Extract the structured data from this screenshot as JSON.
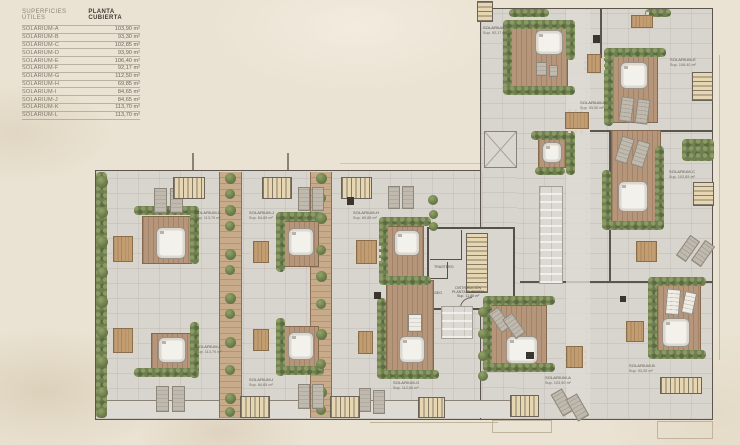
{
  "legend": {
    "title_left": "SUPERFICIES ÚTILES",
    "title_right": "PLANTA CUBIERTA",
    "rows": [
      {
        "name": "SOLARIUM-A",
        "area": "103,90 m²"
      },
      {
        "name": "SOLARIUM-B",
        "area": "93,30 m²"
      },
      {
        "name": "SOLARIUM-C",
        "area": "102,85 m²"
      },
      {
        "name": "SOLARIUM-D",
        "area": "93,90 m²"
      },
      {
        "name": "SOLARIUM-E",
        "area": "106,40 m²"
      },
      {
        "name": "SOLARIUM-F",
        "area": "92,17 m²"
      },
      {
        "name": "SOLARIUM-G",
        "area": "112,50 m²"
      },
      {
        "name": "SOLARIUM-H",
        "area": "69,85 m²"
      },
      {
        "name": "SOLARIUM-I",
        "area": "84,65 m²"
      },
      {
        "name": "SOLARIUM-J",
        "area": "84,65 m²"
      },
      {
        "name": "SOLARIUM-K",
        "area": "113,70 m²"
      },
      {
        "name": "SOLARIUM-L",
        "area": "113,70 m²"
      }
    ]
  },
  "units": [
    {
      "label": "SOLARIUM-A",
      "sup": "Sup. 103,90 m²"
    },
    {
      "label": "SOLARIUM-B",
      "sup": "Sup. 93,30 m²"
    },
    {
      "label": "SOLARIUM-C",
      "sup": "Sup. 102,85 m²"
    },
    {
      "label": "SOLARIUM-D",
      "sup": "Sup. 93,90 m²"
    },
    {
      "label": "SOLARIUM-E",
      "sup": "Sup. 106,40 m²"
    },
    {
      "label": "SOLARIUM-F",
      "sup": "Sup. 92,17 m²"
    },
    {
      "label": "SOLARIUM-G",
      "sup": "Sup. 112,50 m²"
    },
    {
      "label": "SOLARIUM-H",
      "sup": "Sup. 69,85 m²"
    },
    {
      "label": "SOLARIUM-I",
      "sup": "Sup. 84,65 m²"
    },
    {
      "label": "SOLARIUM-J",
      "sup": "Sup. 84,65 m²"
    },
    {
      "label": "SOLARIUM-K",
      "sup": "Sup. 113,70 m²"
    },
    {
      "label": "SOLARIUM-L",
      "sup": "Sup. 113,70 m²"
    }
  ],
  "core": {
    "trastero": "TRASTERO",
    "aseo": "ASEO",
    "dist_l1": "DISTRIBUCIÓN",
    "dist_l2": "PLANTA CUBIERTA",
    "dist_l3": "Sup. 11,88 m²"
  },
  "colors": {
    "background": "#eae2d2",
    "pavement": "#d8d4ce",
    "wood_deck": "#b5967a",
    "hedge_green": "#6f7f52",
    "wall": "#5b554e",
    "label_text": "#55504a"
  }
}
